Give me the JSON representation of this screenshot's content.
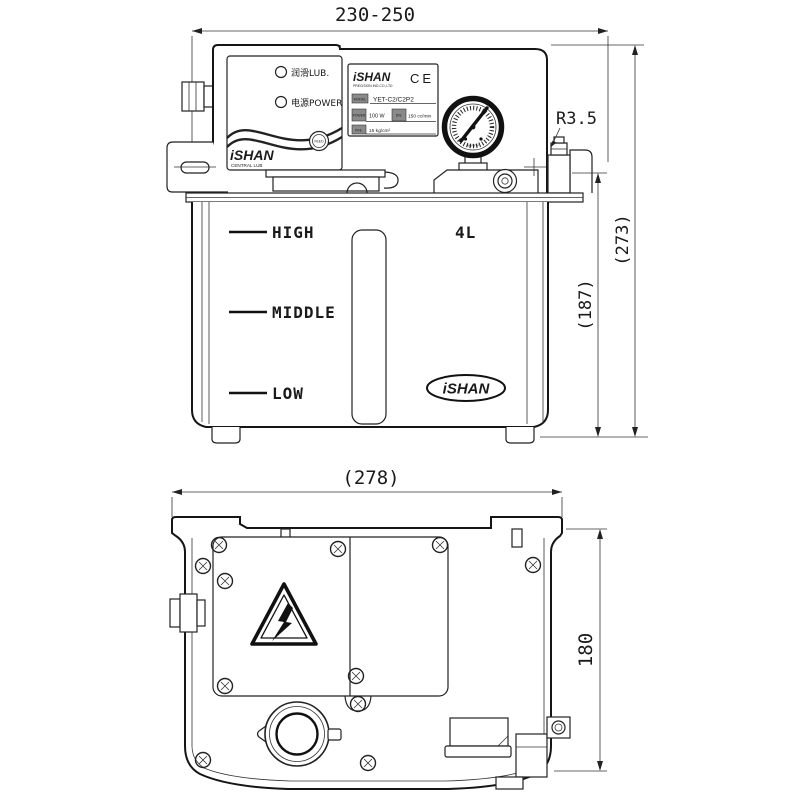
{
  "drawing": {
    "front_view": {
      "dim_width": "230-250",
      "dim_height_total": "(273)",
      "dim_height_tank": "(187)",
      "fitting_radius": "R3.5",
      "control_panel": {
        "indicator_lub": "润滑LUB.",
        "indicator_power": "电源POWER",
        "feed_button": "FEED",
        "brand": "iSHAN",
        "brand_sub": "CENTRAL LUB"
      },
      "nameplate": {
        "brand": "iSHAN",
        "brand_sub": "PRECISION IND.CO.,LTD",
        "ce_mark": "CE",
        "model_label": "MODEL",
        "model_value": "YET-C2/C2P2",
        "power_label": "POWER",
        "power_value": "100 W",
        "discharge_label": "DIS.",
        "discharge_value": "150 cc/min",
        "pressure_label": "PRE.",
        "pressure_value": "15 kg/cm²"
      },
      "gauge_unit": "kg/cm²",
      "tank": {
        "capacity": "4L",
        "level_high": "HIGH",
        "level_middle": "MIDDLE",
        "level_low": "LOW",
        "brand": "iSHAN"
      }
    },
    "rear_view": {
      "dim_width": "(278)",
      "dim_height": "180"
    },
    "colors": {
      "line": "#222222",
      "background": "#ffffff"
    }
  }
}
